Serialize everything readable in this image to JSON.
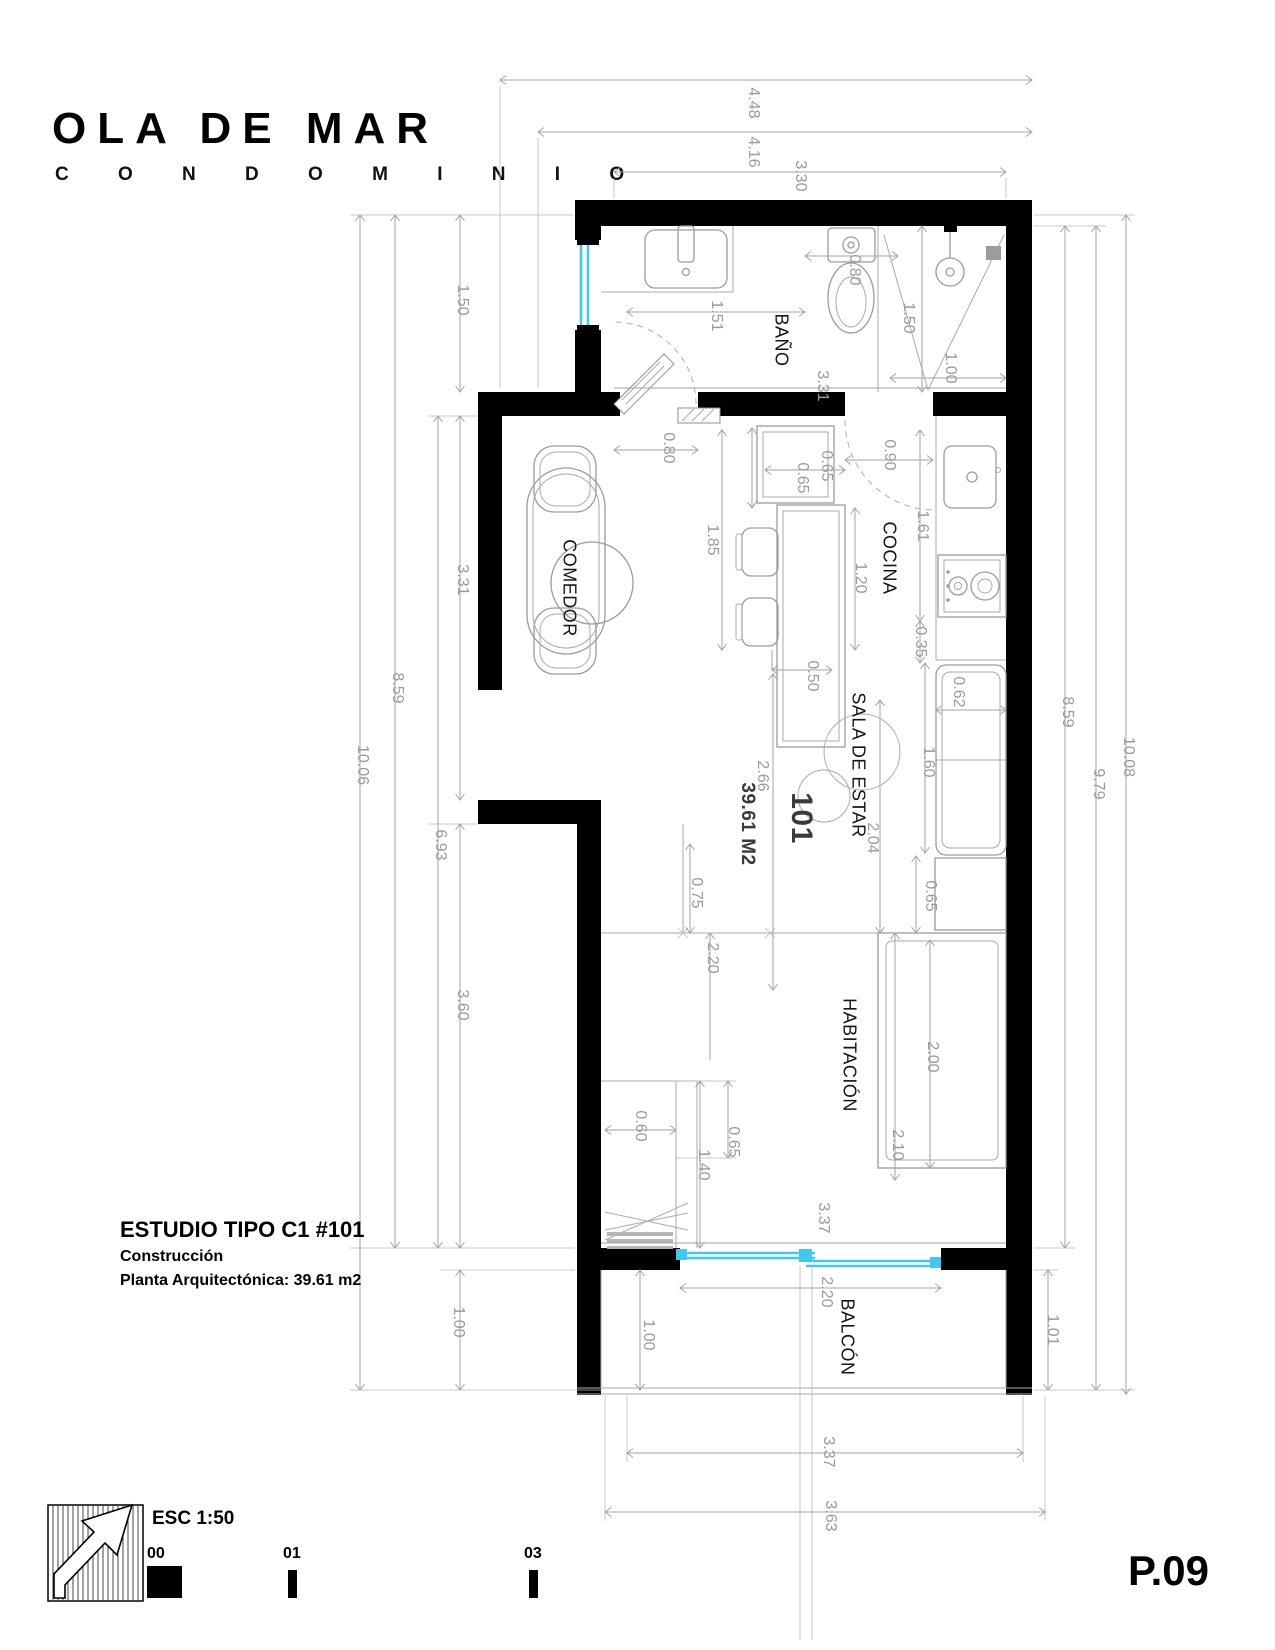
{
  "logo": {
    "title": "OLA DE MAR",
    "subtitle": "C O N D O M I N I O"
  },
  "title_block": {
    "unit_title": "ESTUDIO TIPO C1 #101",
    "line1": "Construcción",
    "line2": "Planta Arquitectónica:  39.61 m2"
  },
  "sheet": {
    "scale_label": "ESC 1:50",
    "scale_marks": [
      "00",
      "01",
      "03"
    ],
    "page_number": "P.09"
  },
  "rooms": {
    "bathroom": "BAÑO",
    "kitchen": "COCINA",
    "dining": "COMEDOR",
    "living": "SALA DE ESTAR",
    "bedroom": "HABITACIÓN",
    "balcony": "BALCÓN",
    "unit_number": "101",
    "unit_area": "39.61 M2"
  },
  "colors": {
    "wall": "#000000",
    "window": "#45c6ee",
    "dimension": "#9b9b9b"
  },
  "dimensions": {
    "top": {
      "d448": "4.48",
      "d416": "4.16",
      "d330": "3.30"
    },
    "left": {
      "d1006": "10.06",
      "d859": "8.59",
      "d693": "6.93",
      "d150": "1.50",
      "d331": "3.31",
      "d360": "3.60",
      "d100": "1.00"
    },
    "right": {
      "d1008": "10.08",
      "d979": "9.79",
      "d859": "8.59",
      "d101": "1.01"
    },
    "bathroom": {
      "d151": "1.51",
      "d080": "0.80",
      "d331": "3.31",
      "d150": "1.50",
      "d100": "1.00"
    },
    "kitchen": {
      "door": "0.80",
      "cab_w": "0.65",
      "cab_d": "0.65",
      "entry": "0.90",
      "island": "1.85",
      "aisle": "1.20",
      "stool": "0.50",
      "counter": "1.61",
      "gap": "0.35",
      "fridge_w": "0.62",
      "fridge_h": "1.60"
    },
    "living": {
      "d266": "2.66",
      "d204": "2.04"
    },
    "bedroom": {
      "d075": "0.75",
      "d220": "2.20",
      "desk": "0.65",
      "bed": "2.00",
      "d210": "2.10",
      "closet_w": "0.60",
      "closet_h": "1.40",
      "closet_d": "0.65"
    },
    "balcony": {
      "width": "3.37",
      "door": "2.20",
      "depth_i": "1.00",
      "depth_r": "1.01"
    },
    "bottom": {
      "inner": "3.37",
      "outer": "3.63"
    }
  }
}
